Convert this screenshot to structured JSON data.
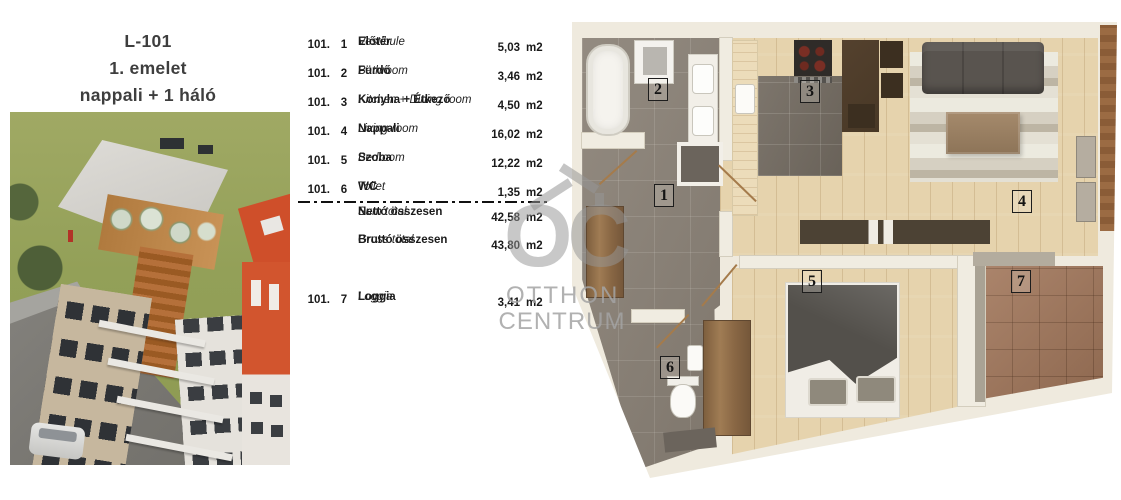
{
  "sheet": {
    "title": "L-101",
    "subtitle1": "1. emelet",
    "subtitle2": "nappali + 1 háló"
  },
  "table": {
    "rows": [
      {
        "unit": "101.",
        "no": "1",
        "name_hu": "Előtér",
        "name_en": "Vestibule",
        "area": "5,03",
        "m2": "m2"
      },
      {
        "unit": "101.",
        "no": "2",
        "name_hu": "Fürdő",
        "name_en": "Bathroom",
        "area": "3,46",
        "m2": "m2"
      },
      {
        "unit": "101.",
        "no": "3",
        "name_hu": "Konyha + Étkező",
        "name_en": "Kitchen + Dining room",
        "area": "4,50",
        "m2": "m2"
      },
      {
        "unit": "101.",
        "no": "4",
        "name_hu": "Nappali",
        "name_en": "Living-room",
        "area": "16,02",
        "m2": "m2"
      },
      {
        "unit": "101.",
        "no": "5",
        "name_hu": "Szoba",
        "name_en": "Bedroom",
        "area": "12,22",
        "m2": "m2"
      },
      {
        "unit": "101.",
        "no": "6",
        "name_hu": "WC",
        "name_en": "Toilet",
        "area": "1,35",
        "m2": "m2"
      }
    ],
    "totals": [
      {
        "name_hu": "Nettó összesen",
        "name_en": "Sum total",
        "area": "42,58",
        "m2": "m2"
      },
      {
        "name_hu": "Bruttó összesen",
        "name_en": "Gross total",
        "area": "43,80",
        "m2": "m2"
      }
    ],
    "loggia": {
      "unit": "101.",
      "no": "7",
      "name_hu": "Loggia",
      "name_en": "Loggia",
      "area": "3,41",
      "m2": "m2"
    }
  },
  "watermark": {
    "monogram": "OC",
    "line1": "OTTHON",
    "line2": "CENTRUM"
  },
  "floorplan": {
    "labels": [
      {
        "n": "1"
      },
      {
        "n": "2"
      },
      {
        "n": "3"
      },
      {
        "n": "4"
      },
      {
        "n": "5"
      },
      {
        "n": "6"
      },
      {
        "n": "7"
      }
    ]
  },
  "colors": {
    "tile_gray": "#8b8277",
    "wood": "#e6d3ad",
    "kitchen_tile": "#756d63",
    "loggia_tile": "#a1765a",
    "wall_cream": "#efeade",
    "accent_orange": "#d2552e",
    "watermark_gray": "#a3a3a3"
  }
}
